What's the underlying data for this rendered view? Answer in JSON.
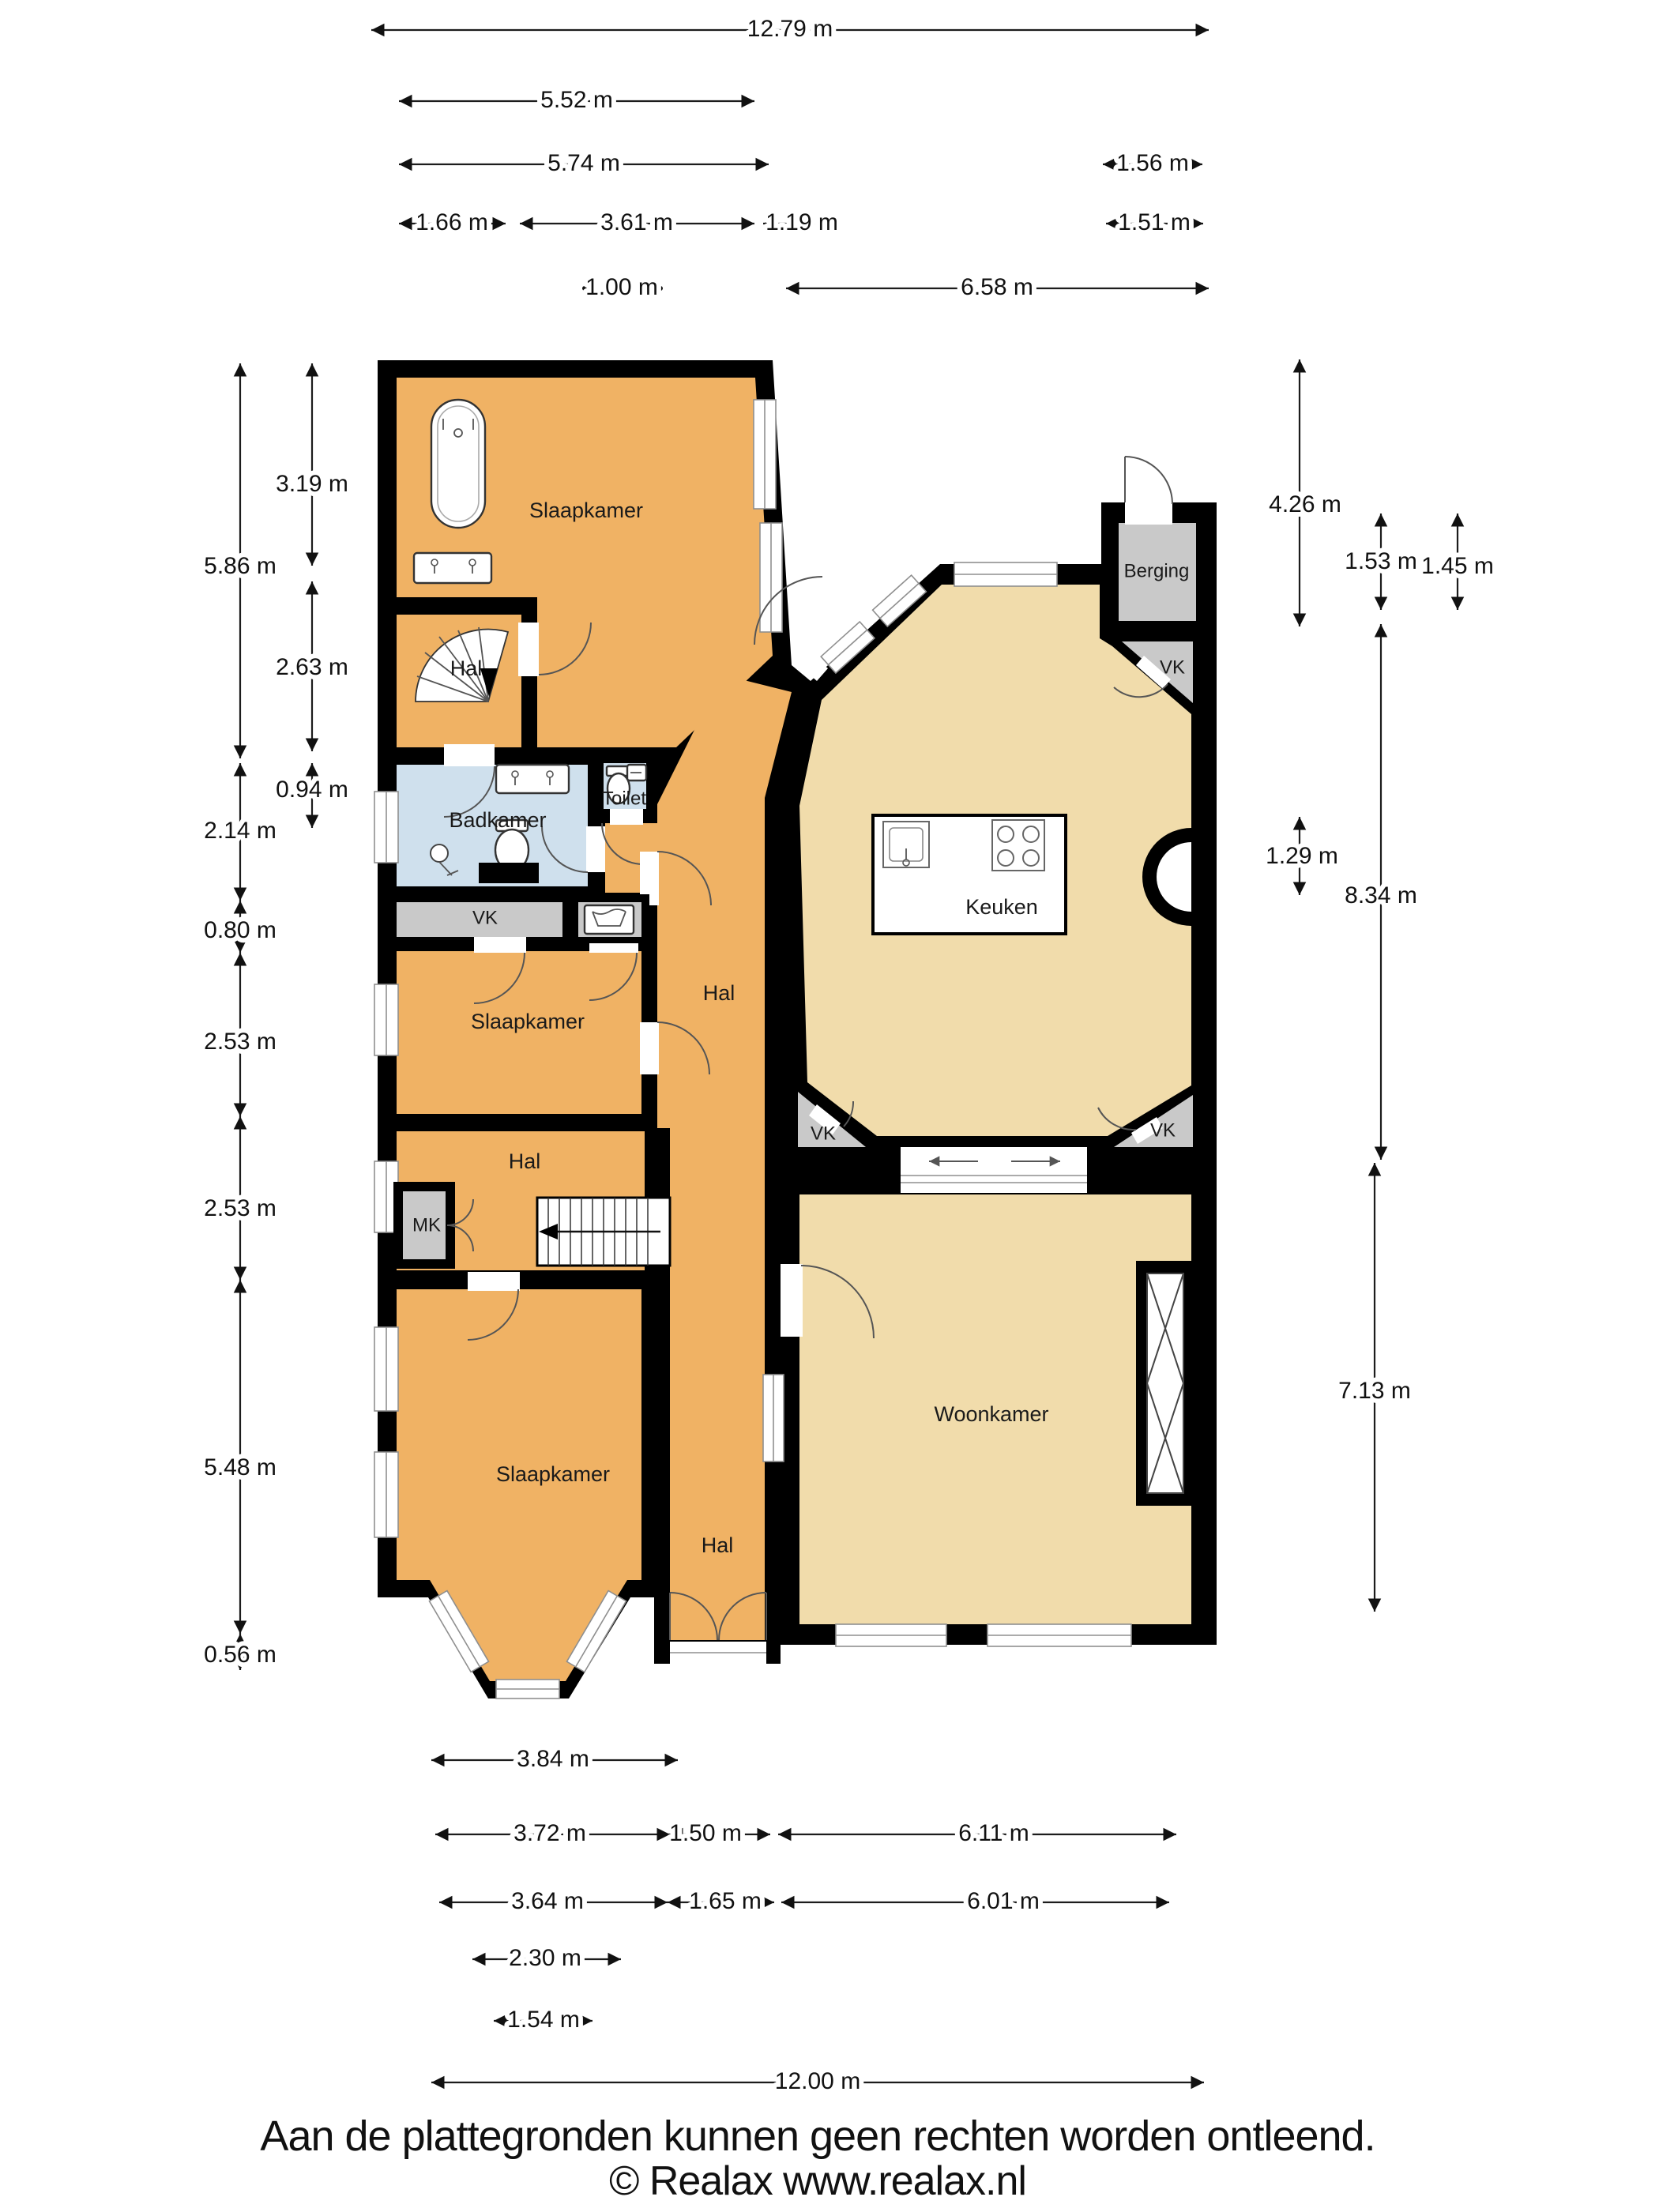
{
  "page": {
    "background": "#ffffff"
  },
  "colors": {
    "wall": "#000000",
    "bedroom_orange": "#f0b264",
    "living_tan": "#f1dcab",
    "bath_blue": "#cfe0ed",
    "closet_gray": "#c9c9c9"
  },
  "rooms": {
    "slaapkamer": "Slaapkamer",
    "hal": "Hal",
    "badkamer": "Badkamer",
    "toilet": "Toilet",
    "keuken": "Keuken",
    "woonkamer": "Woonkamer",
    "berging": "Berging",
    "vk": "VK",
    "mk": "MK"
  },
  "dimensions": {
    "top": [
      "12.79 m",
      "5.52 m",
      "5.74 m",
      "1.56 m",
      "1.66 m",
      "3.61 m",
      "1.19 m",
      "1.51 m",
      "1.00 m",
      "6.58 m"
    ],
    "left": [
      "3.19 m",
      "5.86 m",
      "2.63 m",
      "0.94 m",
      "2.14 m",
      "0.80 m",
      "2.53 m",
      "2.53 m",
      "5.48 m",
      "0.56 m"
    ],
    "right": [
      "4.26 m",
      "1.53 m",
      "1.45 m",
      "1.29 m",
      "8.34 m",
      "7.13 m"
    ],
    "bottom": [
      "3.84 m",
      "3.72 m",
      "1.50 m",
      "6.11 m",
      "3.64 m",
      "1.65 m",
      "6.01 m",
      "2.30 m",
      "1.54 m",
      "12.00 m"
    ]
  },
  "footer": {
    "disclaimer": "Aan de plattegronden kunnen geen rechten worden ontleend.",
    "copyright": "© Realax www.realax.nl"
  }
}
